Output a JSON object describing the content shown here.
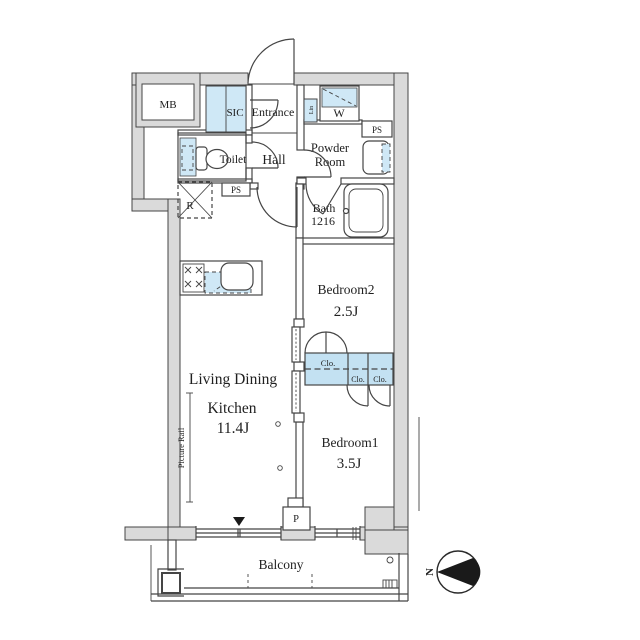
{
  "plan": {
    "rooms": {
      "mb": "MB",
      "sic": "SIC",
      "entrance": "Entrance",
      "washer": "W",
      "linen": "Lin",
      "ps_upper": "PS",
      "toilet": "Toilet",
      "hall": "Hall",
      "powder_line1": "Powder",
      "powder_line2": "Room",
      "ps_lower": "PS",
      "refrigerator": "R",
      "bath_line1": "Bath",
      "bath_line2": "1216",
      "bedroom2": "Bedroom2",
      "bedroom2_size": "2.5J",
      "ldk_line1": "Living Dining",
      "ldk_line2": "Kitchen",
      "ldk_size": "11.4J",
      "closet_main": "Clo.",
      "closet_small1": "Clo.",
      "closet_small2": "Clo.",
      "bedroom1": "Bedroom1",
      "bedroom1_size": "3.5J",
      "pillar": "P",
      "balcony": "Balcony",
      "picture_rail": "Picture Rail"
    },
    "compass": {
      "north_label": "N"
    }
  },
  "colors": {
    "wall_fill": "#dadada",
    "line": "#454545",
    "fixture_blue": "#cfe8f6",
    "closet_blue": "#c3e1f2",
    "text": "#1f1f1f",
    "background": "#ffffff"
  }
}
